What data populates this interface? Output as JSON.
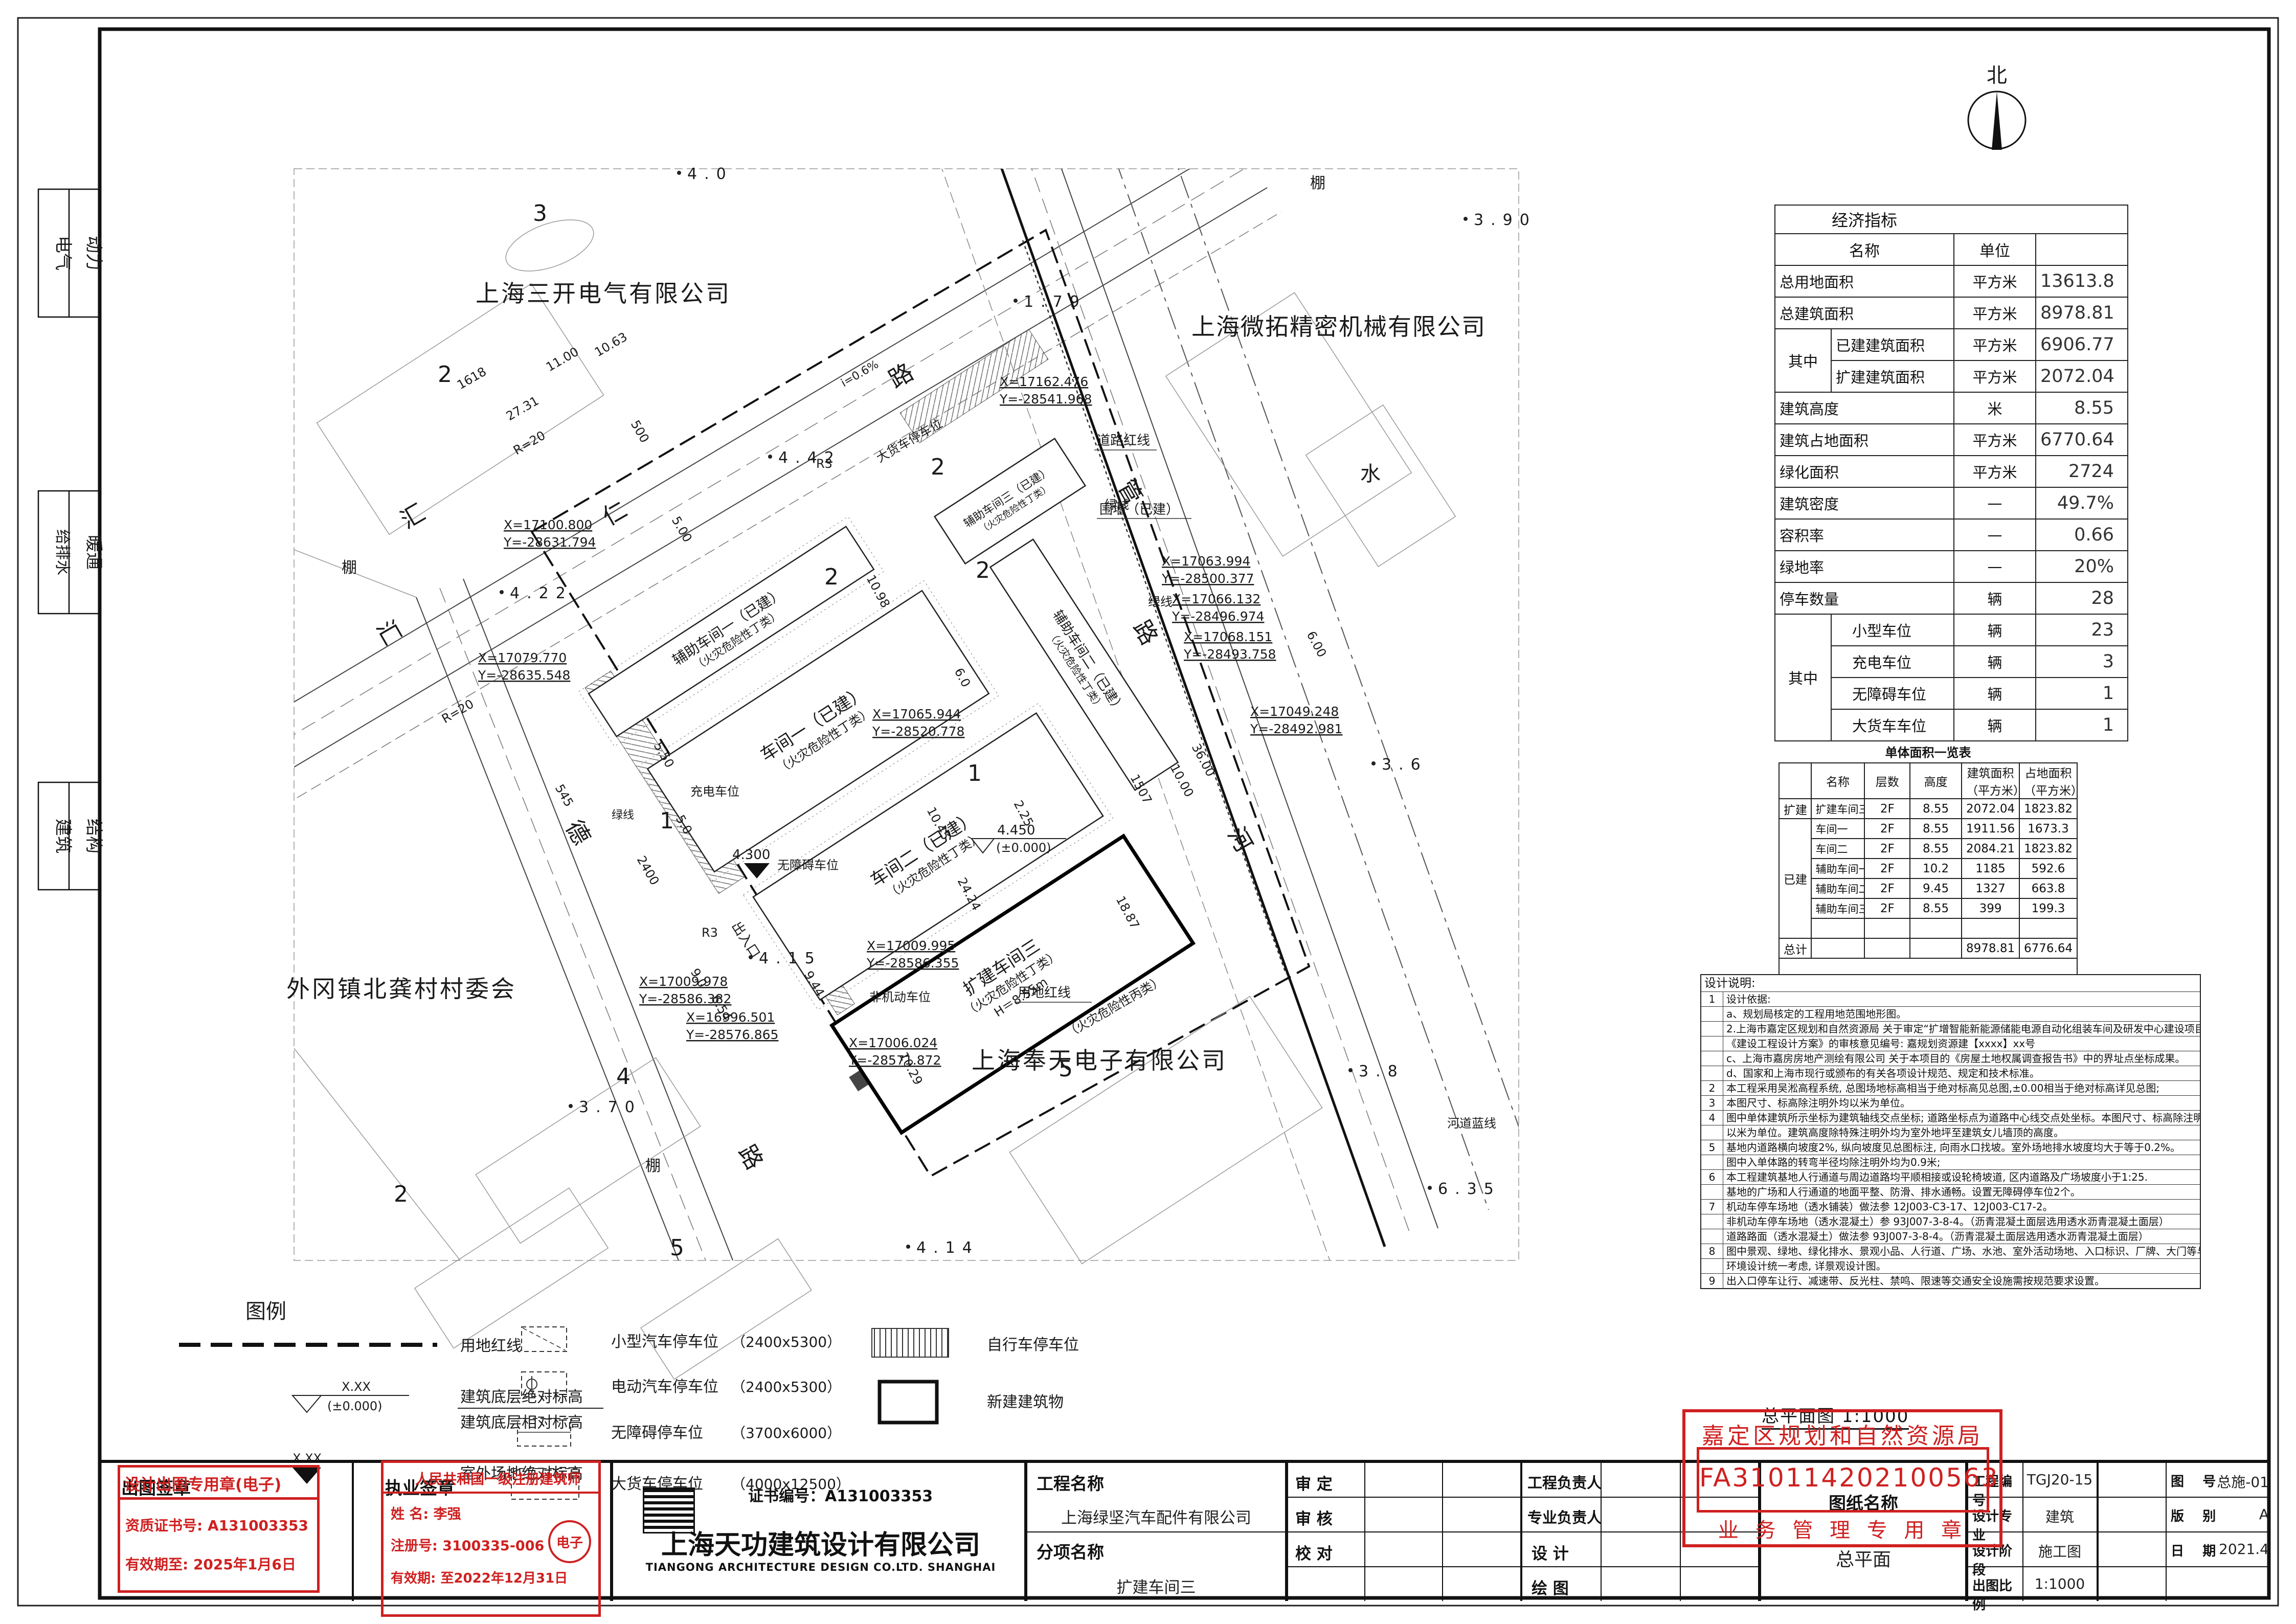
{
  "sheet": {
    "margin_disciplines": {
      "d1": "电气",
      "d2": "动力",
      "d3": "给排水",
      "d4": "暖通",
      "d5": "建筑",
      "d6": "结构"
    },
    "north_label": "北"
  },
  "plan": {
    "neighbors": {
      "sankai": "上海三开电气有限公司",
      "weituo": "上海微拓精密机械有限公司",
      "cun": "外冈镇北龚村村委会",
      "fengtian": "上海奉天电子有限公司",
      "fire_c": "（火灾危险性丙类）"
    },
    "road_chars": {
      "hui1": "汇",
      "hui2": "汇",
      "ren": "仁",
      "de": "德",
      "lu1": "路",
      "lu2": "路",
      "lu3": "路",
      "guan": "管",
      "he": "河",
      "shui": "水",
      "peng1": "棚",
      "peng2": "棚",
      "peng3": "棚"
    },
    "buildings": {
      "aux1": "辅助车间一（已建）",
      "aux1b": "（火灾危险性丁类）",
      "w1": "车间一（已建）",
      "w1b": "（火灾危险性丁类）",
      "w2": "车间二（已建）",
      "w2b": "（火灾危险性丁类）",
      "w3": "扩建车间三",
      "w3b": "（火灾危险性丁类）",
      "w3c": "H＝8.55m",
      "aux2": "辅助车间二（已建）",
      "aux2b": "（火灾危险性丁类）",
      "aux3": "辅助车间三（已建）",
      "aux3b": "（火灾危险性丁类）"
    },
    "labels": {
      "redline": "用地红线",
      "roadred": "道路红线",
      "green": "绿线",
      "green2": "绿线",
      "green3": "绿线",
      "blueline": "河道蓝线",
      "wall": "围墙（已建）",
      "entrance": "出入口",
      "truck": "大货车停车位",
      "charge": "充电车位",
      "barrierfree": "无障碍车位",
      "nonmotor": "非机动车位",
      "slope": "i=0.6%"
    },
    "marks": {
      "m1v": "4.450",
      "m1r": "(±0.000)",
      "m2v": "4.300"
    },
    "coords": [
      [
        "X=17100.800",
        "Y=-28631.794"
      ],
      [
        "X=17079.770",
        "Y=-28635.548"
      ],
      [
        "X=17162.476",
        "Y=-28541.968"
      ],
      [
        "X=17063.994",
        "Y=-28500.377"
      ],
      [
        "X=17066.132",
        "Y=-28496.974"
      ],
      [
        "X=17068.151",
        "Y=-28493.758"
      ],
      [
        "X=17049.248",
        "Y=-28492.981"
      ],
      [
        "X=17065.944",
        "Y=-28520.778"
      ],
      [
        "X=17009.995",
        "Y=-28586.355"
      ],
      [
        "X=17009.978",
        "Y=-28586.382"
      ],
      [
        "X=16996.501",
        "Y=-28576.865"
      ],
      [
        "X=17006.024",
        "Y=-28571.872"
      ]
    ],
    "spots": [
      "4.0",
      "3.90",
      "1.79",
      "4.42",
      "4.22",
      "4.15",
      "4.14",
      "3.70",
      "6.35",
      "3.8",
      "3.6"
    ],
    "dims": [
      "R=20",
      "R=20",
      "R3",
      "R3",
      "2400",
      "5.50",
      "5.0",
      "9.0",
      "6.54",
      "9.44",
      "24.24",
      "36.00",
      "6.00",
      "10.00",
      "18.87",
      "10.98",
      "1507",
      "545",
      "2.25",
      "10.45",
      "10.29",
      "1618",
      "27.31",
      "11.00",
      "10.63",
      "500",
      "5.00",
      "6.0"
    ],
    "lots": [
      "3",
      "2",
      "2",
      "2",
      "1",
      "1",
      "2",
      "4",
      "5",
      "5",
      "2"
    ]
  },
  "eco": {
    "title": "经济指标",
    "col_name": "名称",
    "col_unit": "单位",
    "rows": [
      {
        "name": "总用地面积",
        "unit": "平方米",
        "value": "13613.8"
      },
      {
        "name": "总建筑面积",
        "unit": "平方米",
        "value": "8978.81"
      },
      {
        "group": "其中",
        "name": "已建建筑面积",
        "unit": "平方米",
        "value": "6906.77"
      },
      {
        "name": "扩建建筑面积",
        "unit": "平方米",
        "value": "2072.04"
      },
      {
        "name": "建筑高度",
        "unit": "米",
        "value": "8.55"
      },
      {
        "name": "建筑占地面积",
        "unit": "平方米",
        "value": "6770.64"
      },
      {
        "name": "绿化面积",
        "unit": "平方米",
        "value": "2724"
      },
      {
        "name": "建筑密度",
        "unit": "—",
        "value": "49.7%"
      },
      {
        "name": "容积率",
        "unit": "—",
        "value": "0.66"
      },
      {
        "name": "绿地率",
        "unit": "—",
        "value": "20%"
      },
      {
        "name": "停车数量",
        "unit": "辆",
        "value": "28"
      },
      {
        "group": "其中",
        "name": "小型车位",
        "unit": "辆",
        "value": "23"
      },
      {
        "name": "充电车位",
        "unit": "辆",
        "value": "3"
      },
      {
        "name": "无障碍车位",
        "unit": "辆",
        "value": "1"
      },
      {
        "name": "大货车车位",
        "unit": "辆",
        "value": "1"
      }
    ]
  },
  "units_table": {
    "title": "单体面积一览表",
    "h_name": "名称",
    "h_floors": "层数",
    "h_height": "高度",
    "h_gfa": "建筑面积",
    "h_gfa2": "（平方米）",
    "h_fp": "占地面积",
    "h_fp2": "（平方米）",
    "g_new": "扩建",
    "g_built": "已建",
    "total_label": "总计",
    "rows": [
      {
        "name": "扩建车间三",
        "floors": "2F",
        "height": "8.55",
        "gfa": "2072.04",
        "fp": "1823.82"
      },
      {
        "name": "车间一",
        "floors": "2F",
        "height": "8.55",
        "gfa": "1911.56",
        "fp": "1673.3"
      },
      {
        "name": "车间二",
        "floors": "2F",
        "height": "8.55",
        "gfa": "2084.21",
        "fp": "1823.82"
      },
      {
        "name": "辅助车间一",
        "floors": "2F",
        "height": "10.2",
        "gfa": "1185",
        "fp": "592.6"
      },
      {
        "name": "辅助车间二",
        "floors": "2F",
        "height": "9.45",
        "gfa": "1327",
        "fp": "663.8"
      },
      {
        "name": "辅助车间三",
        "floors": "2F",
        "height": "8.55",
        "gfa": "399",
        "fp": "199.3"
      }
    ],
    "total_gfa": "8978.81",
    "total_fp": "6776.64"
  },
  "notes": {
    "title": "设计说明:",
    "rows": [
      {
        "n": "1",
        "t": "设计依据:"
      },
      {
        "n": "",
        "t": "a、规划局核定的工程用地范围地形图。"
      },
      {
        "n": "",
        "t": "2.上海市嘉定区规划和自然资源局 关于审定“扩增智能新能源储能电源自动化组装车间及研发中心建设项目”"
      },
      {
        "n": "",
        "t": "《建设工程设计方案》的审核意见编号: 嘉规划资源建【xxxx】xx号"
      },
      {
        "n": "",
        "t": "c、上海市嘉房房地产测绘有限公司 关于本项目的《房屋土地权属调查报告书》中的界址点坐标成果。"
      },
      {
        "n": "",
        "t": "d、国家和上海市现行或颁布的有关各项设计规范、规定和技术标准。"
      },
      {
        "n": "2",
        "t": "本工程采用吴淞高程系统, 总图场地标高相当于绝对标高见总图,±0.00相当于绝对标高详见总图;"
      },
      {
        "n": "3",
        "t": "本图尺寸、标高除注明外均以米为单位。"
      },
      {
        "n": "4",
        "t": "图中单体建筑所示坐标为建筑轴线交点坐标; 道路坐标点为道路中心线交点处坐标。本图尺寸、标高除注明外均"
      },
      {
        "n": "",
        "t": "以米为单位。建筑高度除特殊注明外均为室外地坪至建筑女儿墙顶的高度。"
      },
      {
        "n": "5",
        "t": "基地内道路横向坡度2%, 纵向坡度见总图标注, 向雨水口找坡。室外场地排水坡度均大于等于0.2%。"
      },
      {
        "n": "",
        "t": "图中入单体路的转弯半径均除注明外均为0.9米;"
      },
      {
        "n": "6",
        "t": "本工程建筑基地人行通道与周边道路均平顺相接或设轮椅坡道, 区内道路及广场坡度小于1:25."
      },
      {
        "n": "",
        "t": "基地的广场和人行通道的地面平整、防滑、排水通畅。设置无障碍停车位2个。"
      },
      {
        "n": "7",
        "t": "机动车停车场地（透水铺装）做法参 12J003-C3-17、12J003-C17-2。"
      },
      {
        "n": "",
        "t": "非机动车停车场地（透水混凝土）参 93J007-3-8-4。（沥青混凝土面层选用透水沥青混凝土面层）"
      },
      {
        "n": "",
        "t": "道路路面（透水混凝土）做法参 93J007-3-8-4。（沥青混凝土面层选用透水沥青混凝土面层）"
      },
      {
        "n": "8",
        "t": "图中景观、绿地、绿化排水、景观小品、人行道、广场、水池、室外活动场地、入口标识、厂牌、大门等与"
      },
      {
        "n": "",
        "t": "环境设计统一考虑, 详景观设计图。"
      },
      {
        "n": "9",
        "t": "出入口停车让行、减速带、反光柱、禁鸣、限速等交通安全设施需按规范要求设置。"
      }
    ]
  },
  "legend": {
    "title": "图例",
    "redline": "用地红线",
    "sym_xx1": "X.XX",
    "sym_zero": "(±0.000)",
    "abs_label": "建筑底层绝对标高",
    "rel_label": "建筑底层相对标高",
    "sym_xx2": "X.XX",
    "site_label": "室外场地绝对标高",
    "p1": "小型汽车停车位",
    "p1d": "（2400x5300）",
    "p2": "电动汽车停车位",
    "p2d": "（2400x5300）",
    "p3": "无障碍停车位",
    "p3d": "（3700x6000）",
    "p4": "大货车停车位",
    "p4d": "（4000x12500）",
    "bike": "自行车停车位",
    "newbuild": "新建建筑物"
  },
  "titleblock": {
    "stamp1": {
      "label": "出图签章",
      "line1": "设计出图专用章(电子)",
      "cert": "资质证书号: A131003353",
      "valid": "有效期至: 2025年1月6日"
    },
    "stamp2": {
      "label": "执业签章",
      "line1": "人民共和国一级注册建筑师",
      "name": "姓 名: 李强",
      "reg": "注册号: 3100335-006",
      "valid": "有效期: 至2022年12月31日",
      "eseal": "电子"
    },
    "company": {
      "cert": "证书编号：A131003353",
      "cn": "上海天功建筑设计有限公司",
      "en": "TIANGONG ARCHITECTURE DESIGN CO.LTD. SHANGHAI"
    },
    "project": {
      "label": "工程名称",
      "value": "上海绿坚汽车配件有限公司",
      "sub_label": "分项名称",
      "sub_value": "扩建车间三"
    },
    "approvals": {
      "a1": "审  定",
      "a2": "审  核",
      "a3": "校  对"
    },
    "roles": {
      "r1": "工程负责人",
      "r2": "专业负责人",
      "r3": "设  计",
      "r4": "绘  图"
    },
    "stamp3": {
      "line1": "嘉定区规划和自然资源局",
      "line2": "FA310114202100563",
      "line3": "业 务 管 理 专 用 章"
    },
    "drawing": {
      "label": "图纸名称",
      "value": "总平面",
      "title_above": "总平面图 1:1000"
    },
    "meta": {
      "l1": "工程编号",
      "v1": "TGJ20-15",
      "l2": "图    号",
      "v2": "总施-01",
      "l3": "设计专业",
      "v3": "建筑",
      "l4": "版    别",
      "v4": "A",
      "l5": "设计阶段",
      "v5": "施工图",
      "l6": "日    期",
      "v6": "2021.4",
      "l7": "出图比例",
      "v7": "1:1000"
    },
    "accent_red": "#cf2020"
  }
}
